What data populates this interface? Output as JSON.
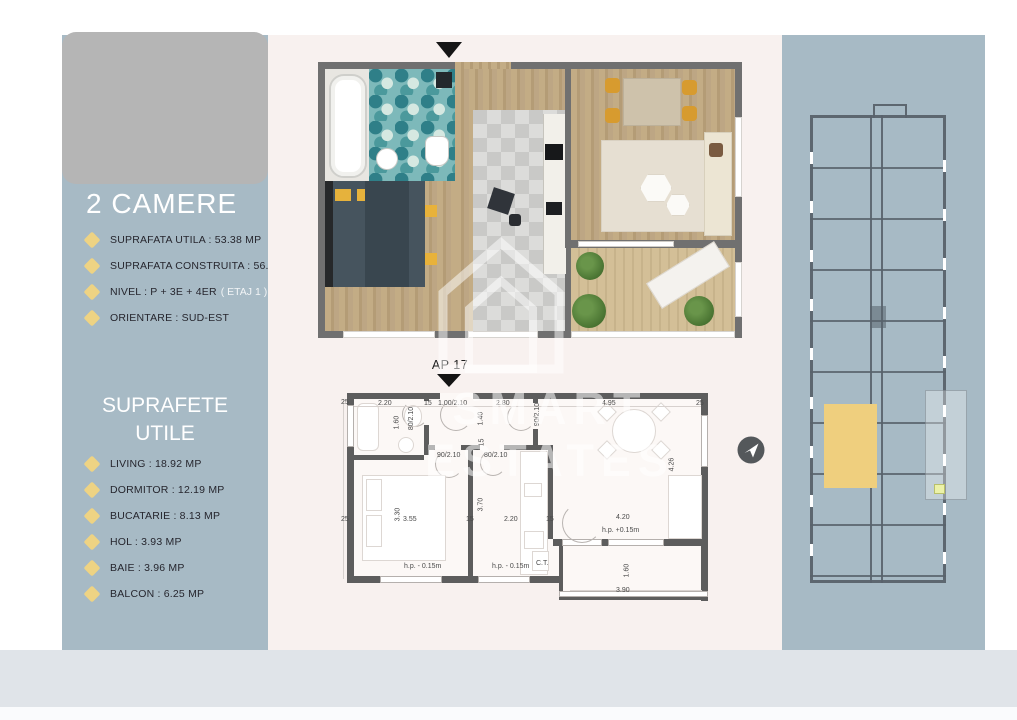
{
  "left_panel": {
    "title": "2 CAMERE",
    "specs": [
      {
        "text": "SUPRAFATA UTILA : 53.38 MP"
      },
      {
        "text": "SUPRAFATA CONSTRUITA : 56.03 MP"
      },
      {
        "text": "NIVEL : P + 3E + 4ER",
        "suffix": "( ETAJ 1 )"
      },
      {
        "text": "ORIENTARE : SUD-EST"
      }
    ],
    "section_title": "SUPRAFETE UTILE",
    "rooms": [
      "LIVING : 18.92 MP",
      "DORMITOR : 12.19 MP",
      "BUCATARIE : 8.13 MP",
      "HOL : 3.93 MP",
      "BAIE : 3.96 MP",
      "BALCON : 6.25 MP"
    ]
  },
  "technical_plan": {
    "unit_label": "AP 17",
    "dimensions": [
      {
        "t": "2.20",
        "x": 38,
        "y": 17
      },
      {
        "t": "80/2.10",
        "x": 60,
        "y": 32,
        "r": 1
      },
      {
        "t": "15",
        "x": 84,
        "y": 17
      },
      {
        "t": "1.00/2.10",
        "x": 98,
        "y": 17
      },
      {
        "t": "2.80",
        "x": 156,
        "y": 17
      },
      {
        "t": "4.95",
        "x": 262,
        "y": 17
      },
      {
        "t": "25",
        "x": 1,
        "y": 16
      },
      {
        "t": "25",
        "x": 356,
        "y": 17
      },
      {
        "t": "1.60",
        "x": 50,
        "y": 36,
        "r": 1
      },
      {
        "t": "1.40",
        "x": 134,
        "y": 32,
        "r": 1
      },
      {
        "t": "90/2.10",
        "x": 186,
        "y": 28,
        "r": 1
      },
      {
        "t": "90/2.10",
        "x": 97,
        "y": 69
      },
      {
        "t": "80/2.10",
        "x": 144,
        "y": 69
      },
      {
        "t": "15",
        "x": 138,
        "y": 56,
        "r": 1
      },
      {
        "t": "4.26",
        "x": 325,
        "y": 78,
        "r": 1
      },
      {
        "t": "25",
        "x": 1,
        "y": 133
      },
      {
        "t": "3.30",
        "x": 51,
        "y": 128,
        "r": 1
      },
      {
        "t": "3.55",
        "x": 63,
        "y": 133
      },
      {
        "t": "15",
        "x": 126,
        "y": 133
      },
      {
        "t": "3.70",
        "x": 134,
        "y": 118,
        "r": 1
      },
      {
        "t": "2.20",
        "x": 164,
        "y": 133
      },
      {
        "t": "15",
        "x": 206,
        "y": 133
      },
      {
        "t": "4.20",
        "x": 276,
        "y": 131
      },
      {
        "t": "h.p. +0.15m",
        "x": 262,
        "y": 144
      },
      {
        "t": "h.p. - 0.15m",
        "x": 64,
        "y": 180
      },
      {
        "t": "h.p. - 0.15m",
        "x": 152,
        "y": 180
      },
      {
        "t": "C.T.",
        "x": 196,
        "y": 177
      },
      {
        "t": "1.60",
        "x": 280,
        "y": 184,
        "r": 1
      },
      {
        "t": "3.90",
        "x": 276,
        "y": 204
      }
    ]
  },
  "watermark": {
    "brand": "SMART ESTATES"
  },
  "colors": {
    "panel_blue": "#a7bac5",
    "accent_yellow": "#eed383",
    "unit_highlight": "#efcf7e",
    "plan_background": "#f8f1ef",
    "wall_gray": "#5d5d5d"
  }
}
